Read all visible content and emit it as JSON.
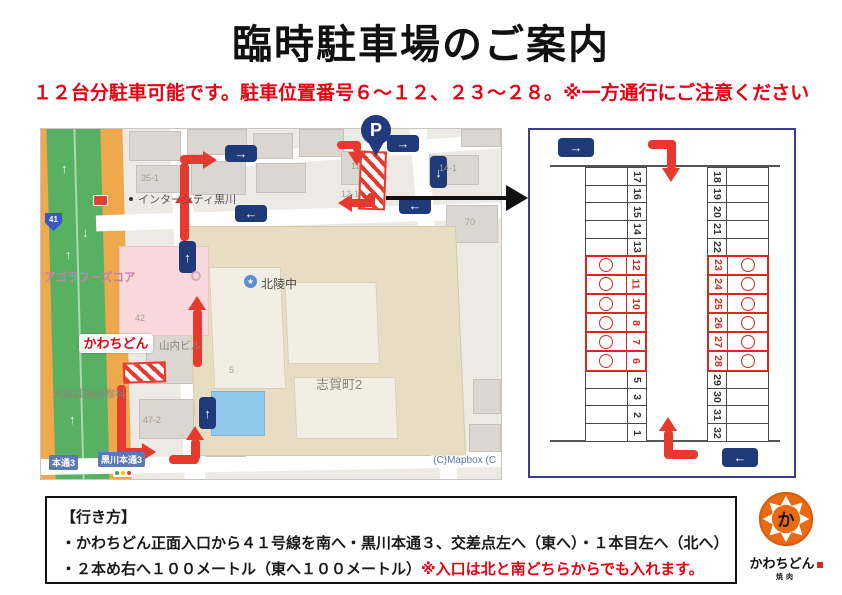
{
  "page": {
    "title": "臨時駐車場のご案内",
    "subtitle": "１２台分駐車可能です。駐車位置番号６～１２、２３～２８。※一方通行にご注意ください"
  },
  "map": {
    "p_marker": "P",
    "route_shield": "41",
    "attribution": "(C)Mapbox  (C",
    "labels": {
      "intercity": "インターシティ黒川",
      "agora_foods": "アゴラフーズコア",
      "hokuryo_school": "北陵中",
      "shigacho": "志賀町2",
      "yamauchi_bldg": "山内ビル",
      "omori_ent": "大森耳鼻咽喉科",
      "kawachidon": "かわちどん",
      "kurokawa_hondori_3": "黒川本通3",
      "hondori_3": "本通3"
    },
    "building_numbers": [
      "35-1",
      "12",
      "12-1",
      "14-1",
      "70",
      "42",
      "47-2",
      "5"
    ],
    "arrow_glyphs": {
      "up": "↑",
      "down": "↓",
      "left": "←",
      "right": "→"
    }
  },
  "diagram": {
    "left_column": [
      {
        "num": "17",
        "reserved": false
      },
      {
        "num": "16",
        "reserved": false
      },
      {
        "num": "15",
        "reserved": false
      },
      {
        "num": "14",
        "reserved": false
      },
      {
        "num": "13",
        "reserved": false
      },
      {
        "num": "12",
        "reserved": true
      },
      {
        "num": "11",
        "reserved": true
      },
      {
        "num": "10",
        "reserved": true
      },
      {
        "num": "8",
        "reserved": true
      },
      {
        "num": "7",
        "reserved": true
      },
      {
        "num": "6",
        "reserved": true
      },
      {
        "num": "5",
        "reserved": false
      },
      {
        "num": "3",
        "reserved": false
      },
      {
        "num": "2",
        "reserved": false
      },
      {
        "num": "1",
        "reserved": false
      }
    ],
    "right_column": [
      {
        "num": "18",
        "reserved": false
      },
      {
        "num": "19",
        "reserved": false
      },
      {
        "num": "20",
        "reserved": false
      },
      {
        "num": "21",
        "reserved": false
      },
      {
        "num": "22",
        "reserved": false
      },
      {
        "num": "23",
        "reserved": true
      },
      {
        "num": "24",
        "reserved": true
      },
      {
        "num": "25",
        "reserved": true
      },
      {
        "num": "26",
        "reserved": true
      },
      {
        "num": "27",
        "reserved": true
      },
      {
        "num": "28",
        "reserved": true
      },
      {
        "num": "29",
        "reserved": false
      },
      {
        "num": "30",
        "reserved": false
      },
      {
        "num": "31",
        "reserved": false
      },
      {
        "num": "32",
        "reserved": false
      }
    ],
    "reserved_mark": "○"
  },
  "directions": {
    "heading": "【行き方】",
    "line1": "・かわちどん正面入口から４１号線を南へ・黒川本通３、交差点左へ（東へ）・１本目左へ（北へ）",
    "line2": "・２本め右へ１００メートル（東へ１００メートル）",
    "line2_note": "※入口は北と南どちらからでも入れます。"
  },
  "logo": {
    "name": "かわちどん",
    "subtext": "焼肉",
    "emblem_char": "か"
  },
  "colors": {
    "accent_red": "#e60012",
    "arrow_red": "#e8392e",
    "navy": "#1e3a78",
    "stall_red": "#d62a20",
    "map_green": "#58b163",
    "map_orange": "#f0a84c",
    "logo_orange": "#e96a10"
  }
}
